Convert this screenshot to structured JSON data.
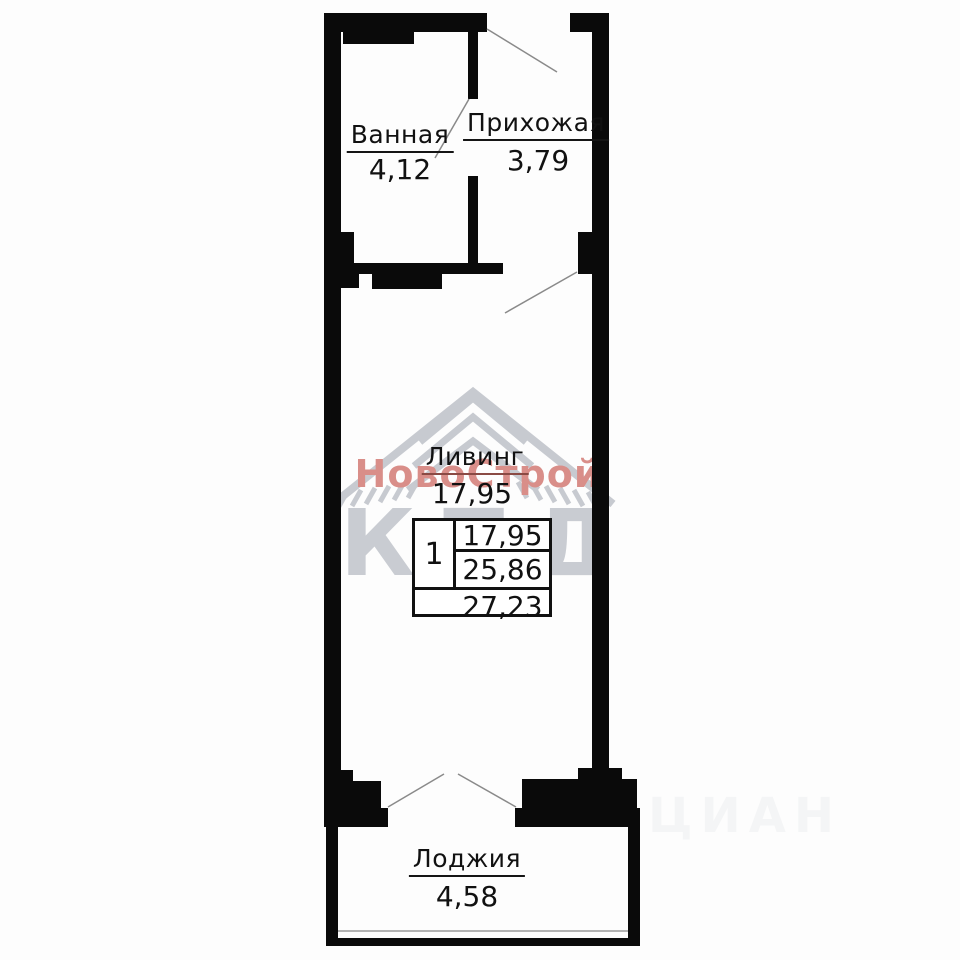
{
  "floor_plan": {
    "rooms": {
      "bathroom": {
        "name": "Ванная",
        "area": "4,12"
      },
      "hallway": {
        "name": "Прихожая",
        "area": "3,79"
      },
      "living": {
        "name": "Ливинг",
        "area": "17,95"
      },
      "loggia": {
        "name": "Лоджия",
        "area": "4,58"
      }
    },
    "info_table": {
      "rooms_count": "1",
      "living_area": "17,95",
      "apartment_area": "25,86",
      "total_area": "27,23"
    }
  },
  "watermarks": {
    "developer_name": "НовоСтрой",
    "developer_abbr": "КПД",
    "portal": "ЦИАН"
  },
  "colors": {
    "wall": "#0a0a0a",
    "door_swing_line": "#8a8a8a",
    "window_line": "#b3b3b3",
    "watermark_red": "#d98e89",
    "watermark_gray": "#c9ccd2",
    "living_underline": "#8a4a44"
  }
}
